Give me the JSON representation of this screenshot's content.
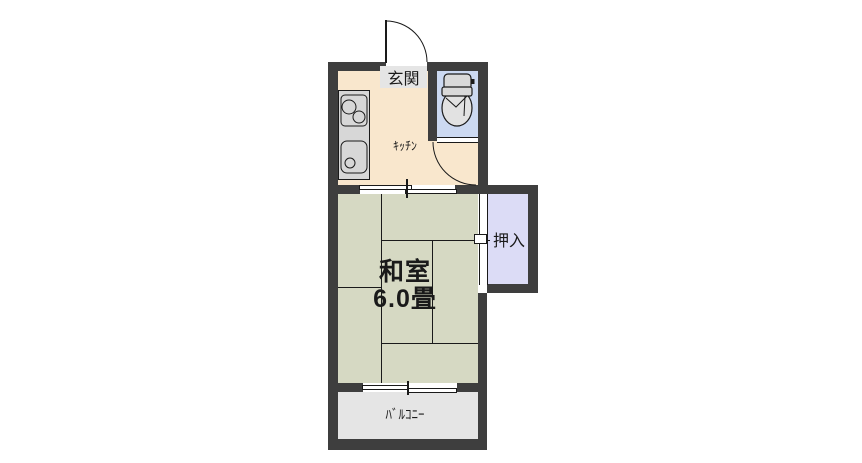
{
  "colors": {
    "background": "#ffffff",
    "wall": "#3e3e3e",
    "line": "#1a1a1a",
    "kitchen_floor": "#f9e7cd",
    "toilet_floor": "#ccd9f1",
    "tatami_floor": "#d6d9c3",
    "closet_floor": "#dcdcf6",
    "balcony_floor": "#e5e5e5",
    "genkan_box": "#e5e5e5",
    "fixture_gray": "#d7d7d7"
  },
  "rooms": {
    "genkan": {
      "label": "玄関"
    },
    "kitchen": {
      "label": "ｷｯﾁﾝ"
    },
    "washitsu": {
      "label": "和室",
      "size": "6.0畳"
    },
    "oshiire": {
      "label": "押入"
    },
    "balcony": {
      "label": "ﾊﾞﾙｺﾆｰ"
    },
    "toilet": {
      "fixture": "toilet"
    }
  }
}
